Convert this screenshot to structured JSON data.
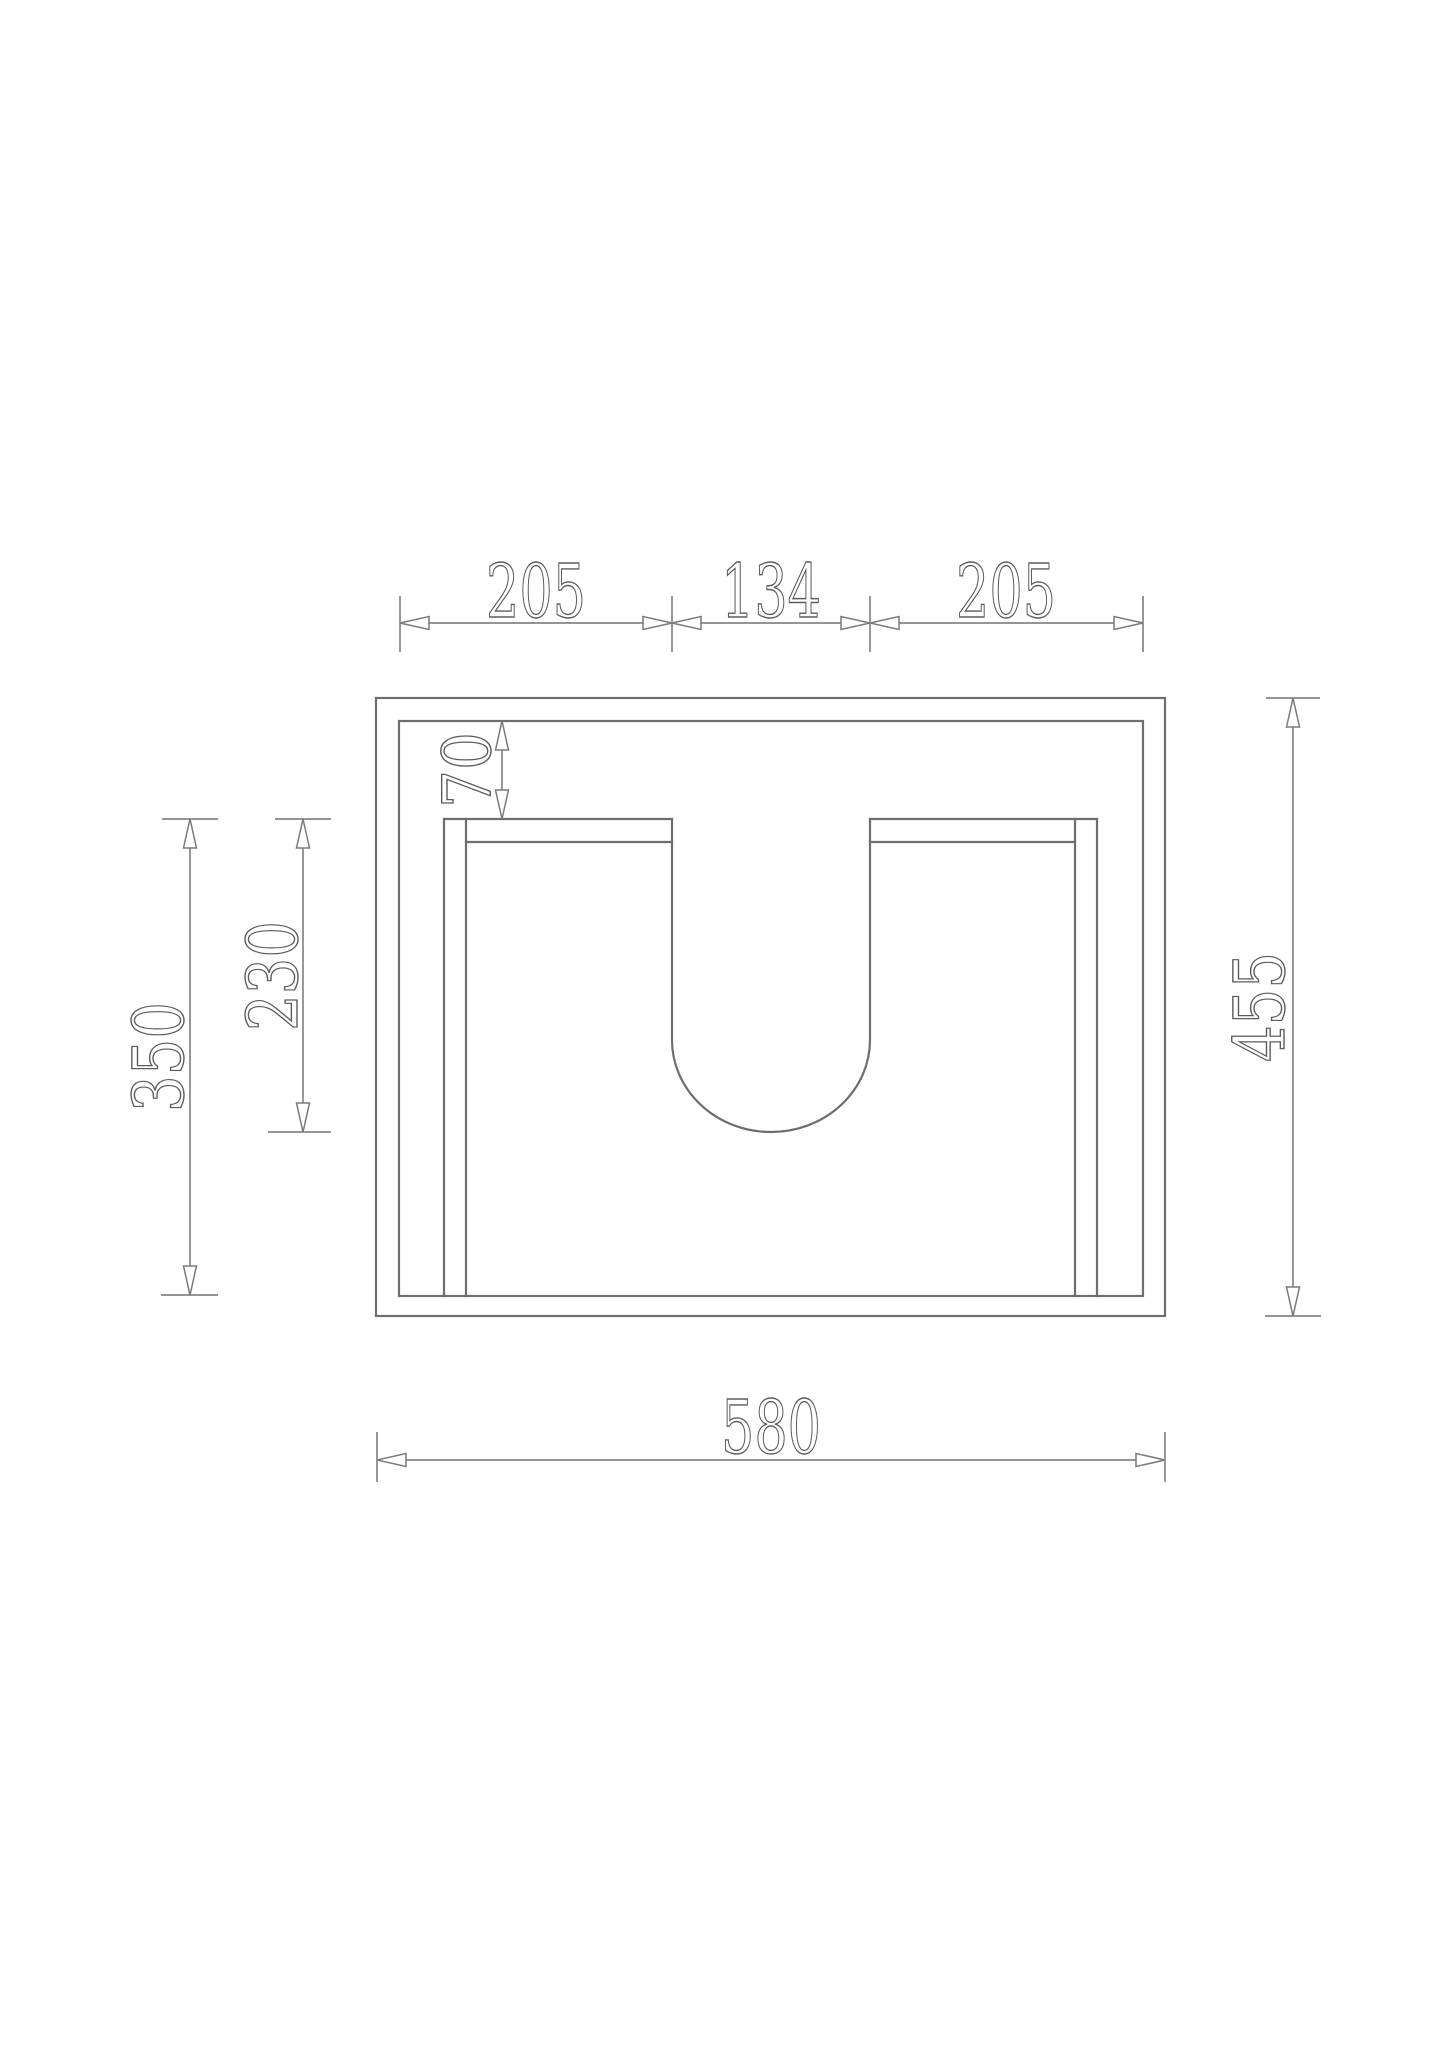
{
  "page": {
    "background": "#ffffff"
  },
  "drawing": {
    "type": "technical-dimension-diagram",
    "view": "front elevation of cabinet with U-shaped cutout",
    "colors": {
      "body_line": "#6e6e6e",
      "dimension_line": "#868686",
      "text_outline": "#5c5c5c",
      "text_fill": "#ffffff"
    },
    "dimensions": {
      "top_left_width": "205",
      "top_center_width": "134",
      "top_right_width": "205",
      "rail_to_panel_offset": "70",
      "cutout_depth": "230",
      "panel_height": "350",
      "overall_height": "455",
      "overall_width": "580"
    }
  }
}
